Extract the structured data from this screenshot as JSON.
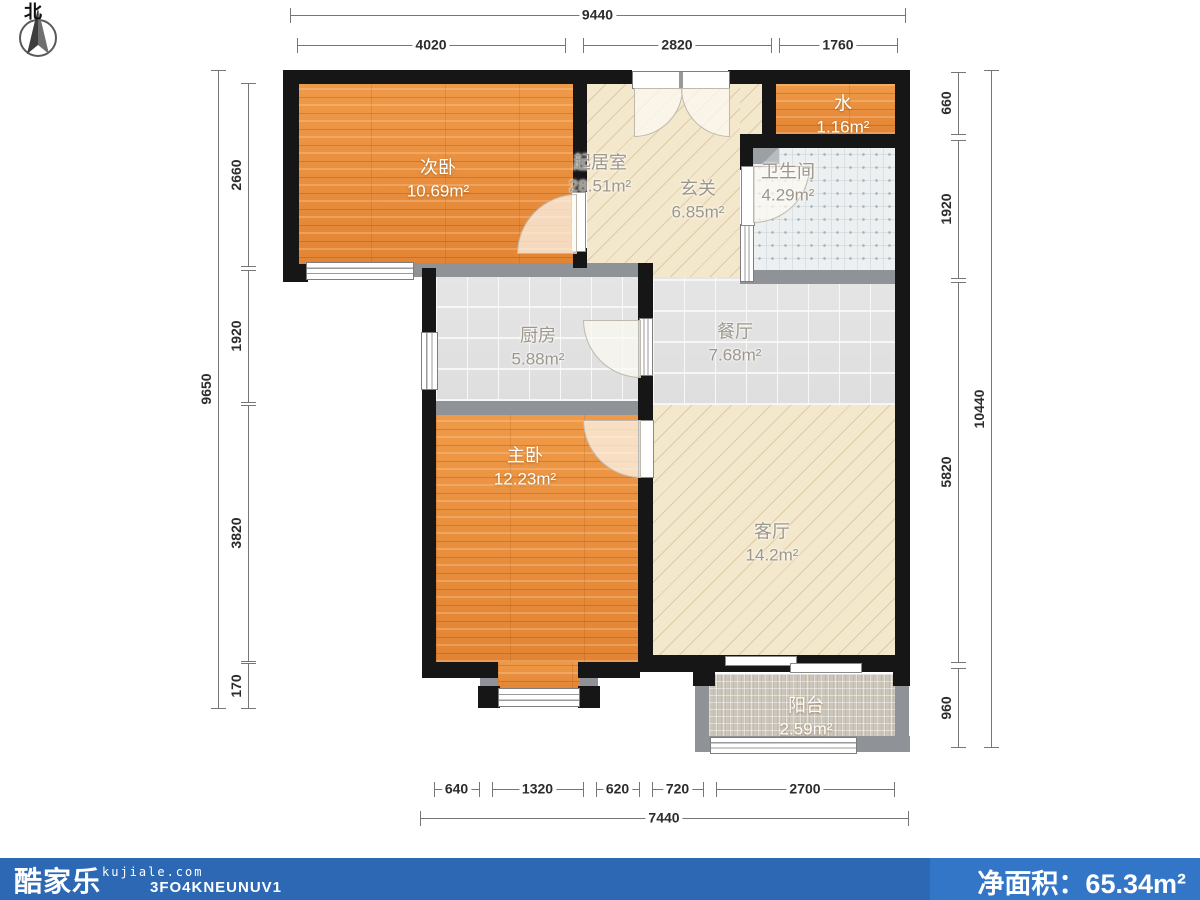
{
  "north": {
    "label": "北"
  },
  "rooms": [
    {
      "name": "次卧",
      "area": "10.69m²",
      "tone": "light",
      "cx": 438,
      "cy": 168
    },
    {
      "name": "起居室",
      "area": "28.51m²",
      "tone": "dark",
      "cx": 600,
      "cy": 163
    },
    {
      "name": "玄关",
      "area": "6.85m²",
      "tone": "dark",
      "cx": 698,
      "cy": 189
    },
    {
      "name": "水",
      "area": "1.16m²",
      "tone": "light",
      "cx": 843,
      "cy": 104
    },
    {
      "name": "卫生间",
      "area": "4.29m²",
      "tone": "dark",
      "cx": 788,
      "cy": 172
    },
    {
      "name": "厨房",
      "area": "5.88m²",
      "tone": "dark",
      "cx": 538,
      "cy": 336
    },
    {
      "name": "餐厅",
      "area": "7.68m²",
      "tone": "dark",
      "cx": 735,
      "cy": 332
    },
    {
      "name": "主卧",
      "area": "12.23m²",
      "tone": "light",
      "cx": 525,
      "cy": 456
    },
    {
      "name": "客厅",
      "area": "14.2m²",
      "tone": "dark",
      "cx": 772,
      "cy": 532
    },
    {
      "name": "阳台",
      "area": "2.59m²",
      "tone": "light",
      "cx": 806,
      "cy": 706
    }
  ],
  "dimensions": {
    "horizontal": [
      {
        "label": "9440",
        "x": 290,
        "y": 15,
        "len": 615
      },
      {
        "label": "4020",
        "x": 297,
        "y": 45,
        "len": 268
      },
      {
        "label": "2820",
        "x": 583,
        "y": 45,
        "len": 188
      },
      {
        "label": "1760",
        "x": 779,
        "y": 45,
        "len": 118
      },
      {
        "label": "640",
        "x": 434,
        "y": 789,
        "len": 45
      },
      {
        "label": "1320",
        "x": 492,
        "y": 789,
        "len": 91
      },
      {
        "label": "620",
        "x": 596,
        "y": 789,
        "len": 43
      },
      {
        "label": "720",
        "x": 652,
        "y": 789,
        "len": 51
      },
      {
        "label": "2700",
        "x": 716,
        "y": 789,
        "len": 178
      },
      {
        "label": "7440",
        "x": 420,
        "y": 818,
        "len": 488
      }
    ],
    "vertical": [
      {
        "label": "9650",
        "x": 218,
        "y": 70,
        "len": 638
      },
      {
        "label": "2660",
        "x": 248,
        "y": 83,
        "len": 183
      },
      {
        "label": "1920",
        "x": 248,
        "y": 270,
        "len": 132
      },
      {
        "label": "3820",
        "x": 248,
        "y": 405,
        "len": 256
      },
      {
        "label": "170",
        "x": 248,
        "y": 663,
        "len": 45
      },
      {
        "label": "660",
        "x": 958,
        "y": 72,
        "len": 62
      },
      {
        "label": "1920",
        "x": 958,
        "y": 140,
        "len": 138
      },
      {
        "label": "5820",
        "x": 958,
        "y": 282,
        "len": 380
      },
      {
        "label": "960",
        "x": 958,
        "y": 668,
        "len": 79
      },
      {
        "label": "10440",
        "x": 991,
        "y": 70,
        "len": 677
      }
    ]
  },
  "footer": {
    "logo": "酷家乐",
    "website": "kujiale.com",
    "plan_code": "3FO4KNEUNUV1",
    "net_area_label": "净面积：",
    "net_area_value": "65.34m²"
  },
  "colors": {
    "wall": "#161616",
    "wood": "#e78f3c",
    "beige": "#f4e8cc",
    "tile": "#e3e3e3",
    "bath_tile": "#edf0f0",
    "balcony": "#cbc5ba",
    "footer_left": "#2d68b4",
    "footer_right": "#3376c7"
  }
}
